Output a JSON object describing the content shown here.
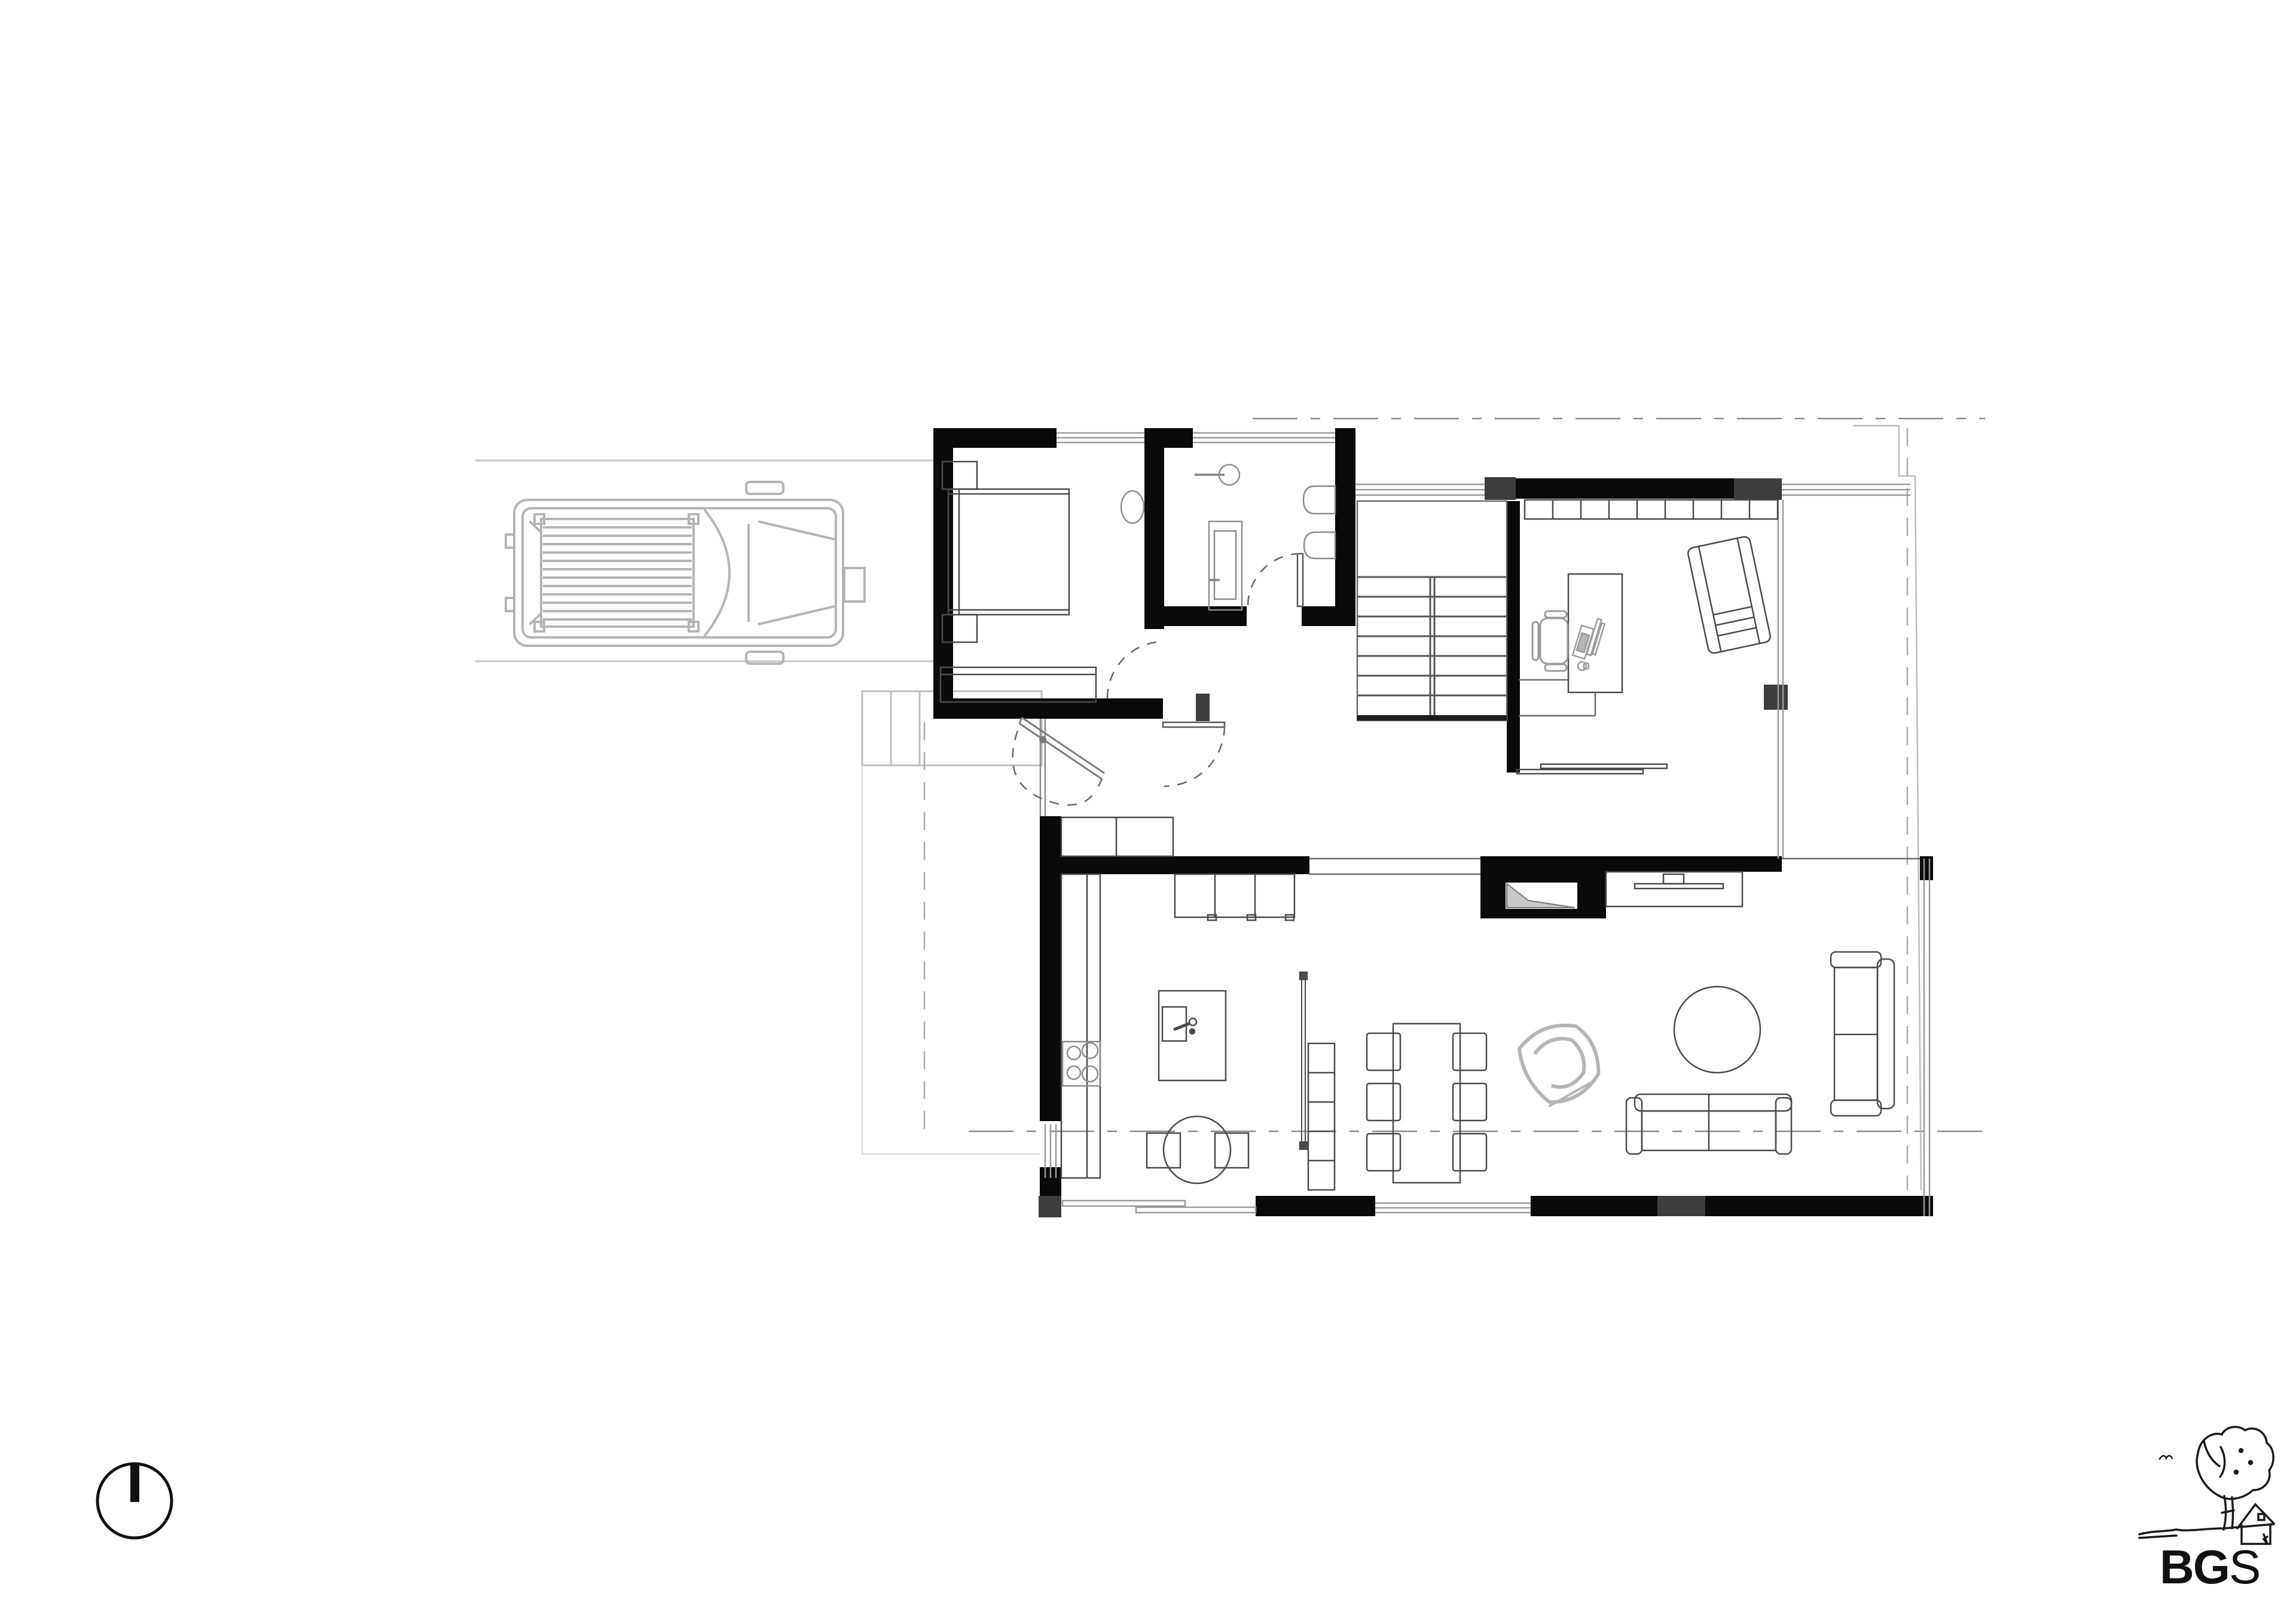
{
  "logo": {
    "bold": "BG",
    "light": "S"
  },
  "theme": {
    "background": "#ffffff",
    "wall_fill": "#0a0a0a",
    "pier_fill": "#3d3d3d",
    "furniture_line": "#4a4a4a",
    "soft_gray": "#b5b5b5",
    "site_gray": "#c6c6c6",
    "glass_line": "#9a9a9a",
    "fire_wedge": "#c9c9c9",
    "logo_ink": "#111111"
  },
  "symbols": [
    "north-arrow-icon",
    "car-icon",
    "bed-icon",
    "nightstand-icon",
    "dresser-icon",
    "sink-icon",
    "bathtub-icon",
    "toilet-icon",
    "stairs-icon",
    "wardrobe-icon",
    "desk-icon",
    "office-chair-icon",
    "armchair-icon",
    "kitchen-island-icon",
    "cooktop-icon",
    "breakfast-table-icon",
    "dining-table-icon",
    "chair-icon",
    "bookshelf-icon",
    "lounge-chair-icon",
    "fireplace-icon",
    "tv-sideboard-icon",
    "sofa-icon",
    "coffee-table-icon",
    "door-swing-icon",
    "tree-house-sketch-icon"
  ]
}
